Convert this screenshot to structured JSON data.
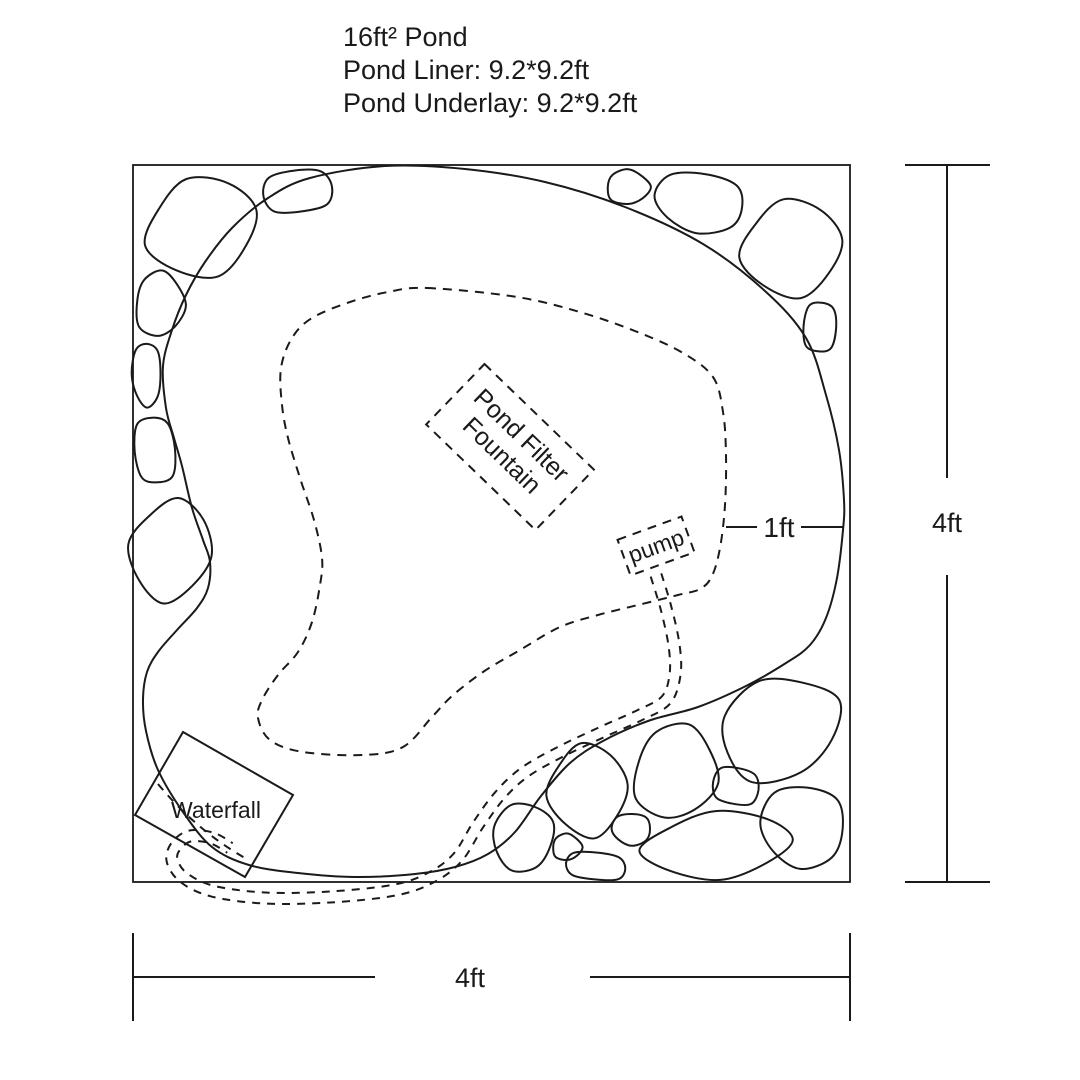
{
  "title": {
    "line1": "16ft² Pond",
    "line2": "Pond Liner: 9.2*9.2ft",
    "line3": "Pond Underlay: 9.2*9.2ft"
  },
  "labels": {
    "waterfall": "Waterfall",
    "pump": "pump",
    "filter_line1": "Pond Filter",
    "filter_line2": "Fountain"
  },
  "dimensions": {
    "width": "4ft",
    "height": "4ft",
    "shelf_offset": "1ft"
  },
  "colors": {
    "line": "#1a1a1a",
    "background": "#ffffff"
  }
}
